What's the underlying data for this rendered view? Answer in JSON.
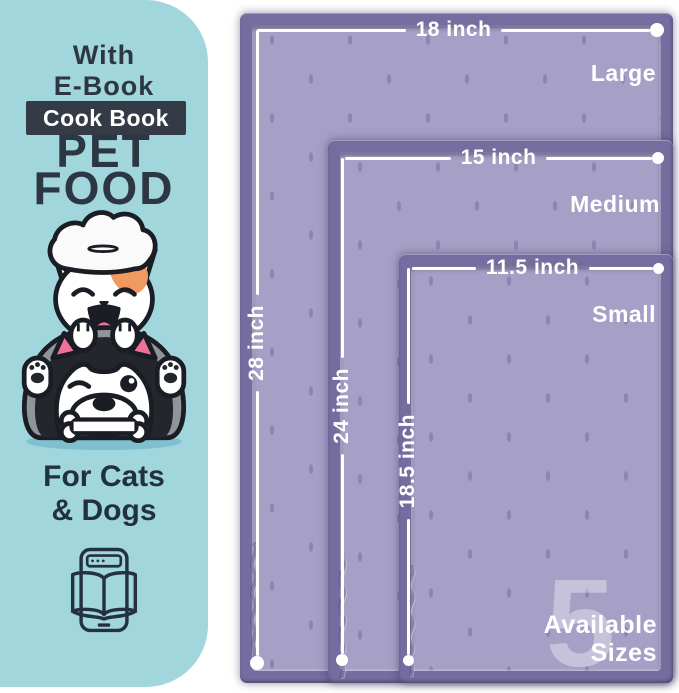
{
  "left_panel": {
    "subtitle_line1": "With",
    "subtitle_line2": "E-Book",
    "badge_label": "Cook Book",
    "title_line1": "PET",
    "title_line2": "FOOD",
    "audience_line1": "For Cats",
    "audience_line2": "& Dogs"
  },
  "size_chart": {
    "mats": [
      {
        "size_name": "Large",
        "width_label": "18 inch",
        "height_label": "28 inch"
      },
      {
        "size_name": "Medium",
        "width_label": "15 inch",
        "height_label": "24 inch"
      },
      {
        "size_name": "Small",
        "width_label": "11.5 inch",
        "height_label": "18.5 inch"
      }
    ],
    "availability_count": "5",
    "availability_line1": "Available",
    "availability_line2": "Sizes"
  },
  "colors": {
    "panel_teal": "#a2d6dd",
    "text_navy": "#2c3743",
    "badge_background": "#343b46",
    "mat_border_purple": "#746d9f",
    "mat_surface_purple": "#a6a0c6",
    "dimension_line_white": "#ffffff",
    "cat_patch_orange": "#f09a62",
    "ear_pink": "#f0709c"
  }
}
